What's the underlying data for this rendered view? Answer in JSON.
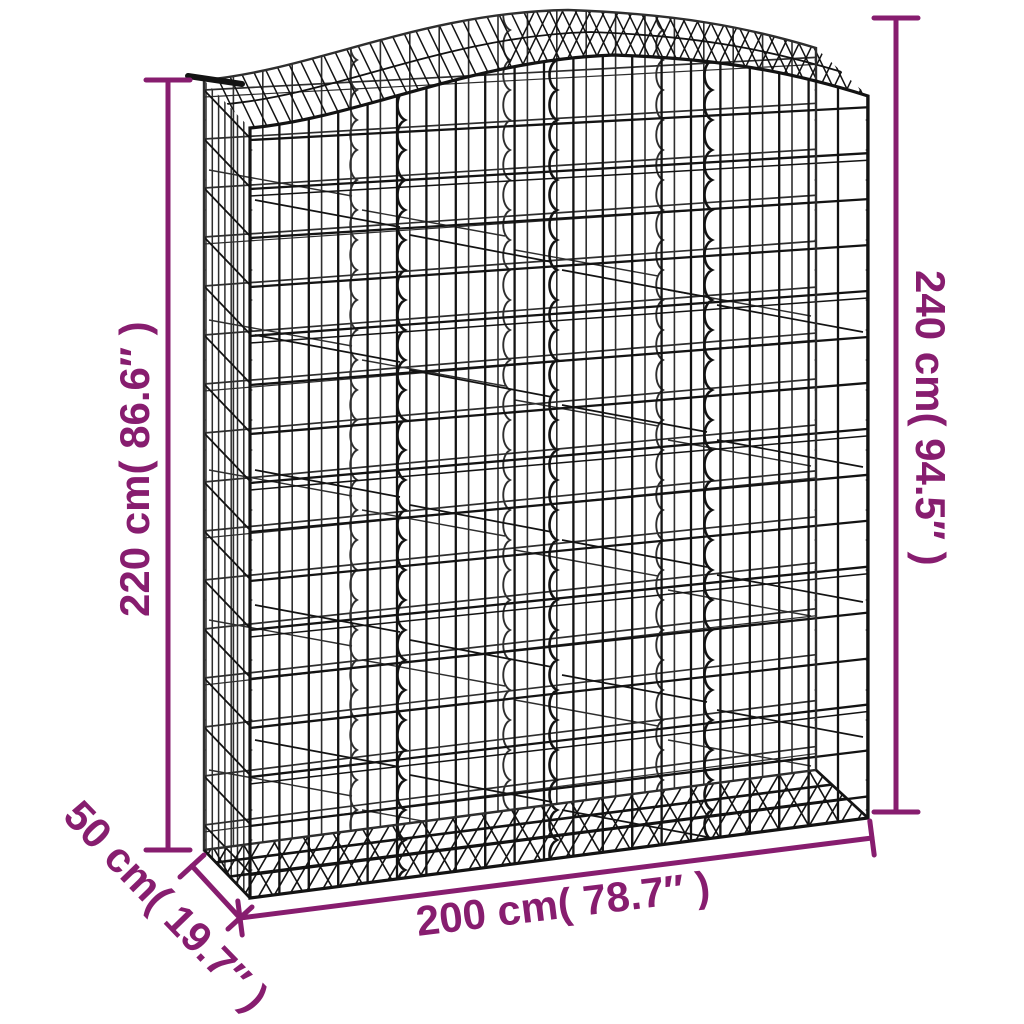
{
  "page": {
    "background": "#ffffff",
    "kind": "product-dimension-diagram",
    "subject": "arched gabion wire mesh basket"
  },
  "product": {
    "name": "arched-gabion-basket",
    "wire_color_front": "#131313",
    "wire_color_back": "#2e2e2e"
  },
  "annotations": {
    "color": "#871d6f",
    "labels": {
      "height_left": "220 cm( 86.6″ )",
      "height_right": "240 cm( 94.5″ )",
      "width_bottom": "200 cm( 78.7″ )",
      "depth": "50 cm( 19.7″ )"
    },
    "values": {
      "height_left_cm": 220,
      "height_left_in": 86.6,
      "height_right_cm": 240,
      "height_right_in": 94.5,
      "width_cm": 200,
      "width_in": 78.7,
      "depth_cm": 50,
      "depth_in": 19.7
    }
  }
}
